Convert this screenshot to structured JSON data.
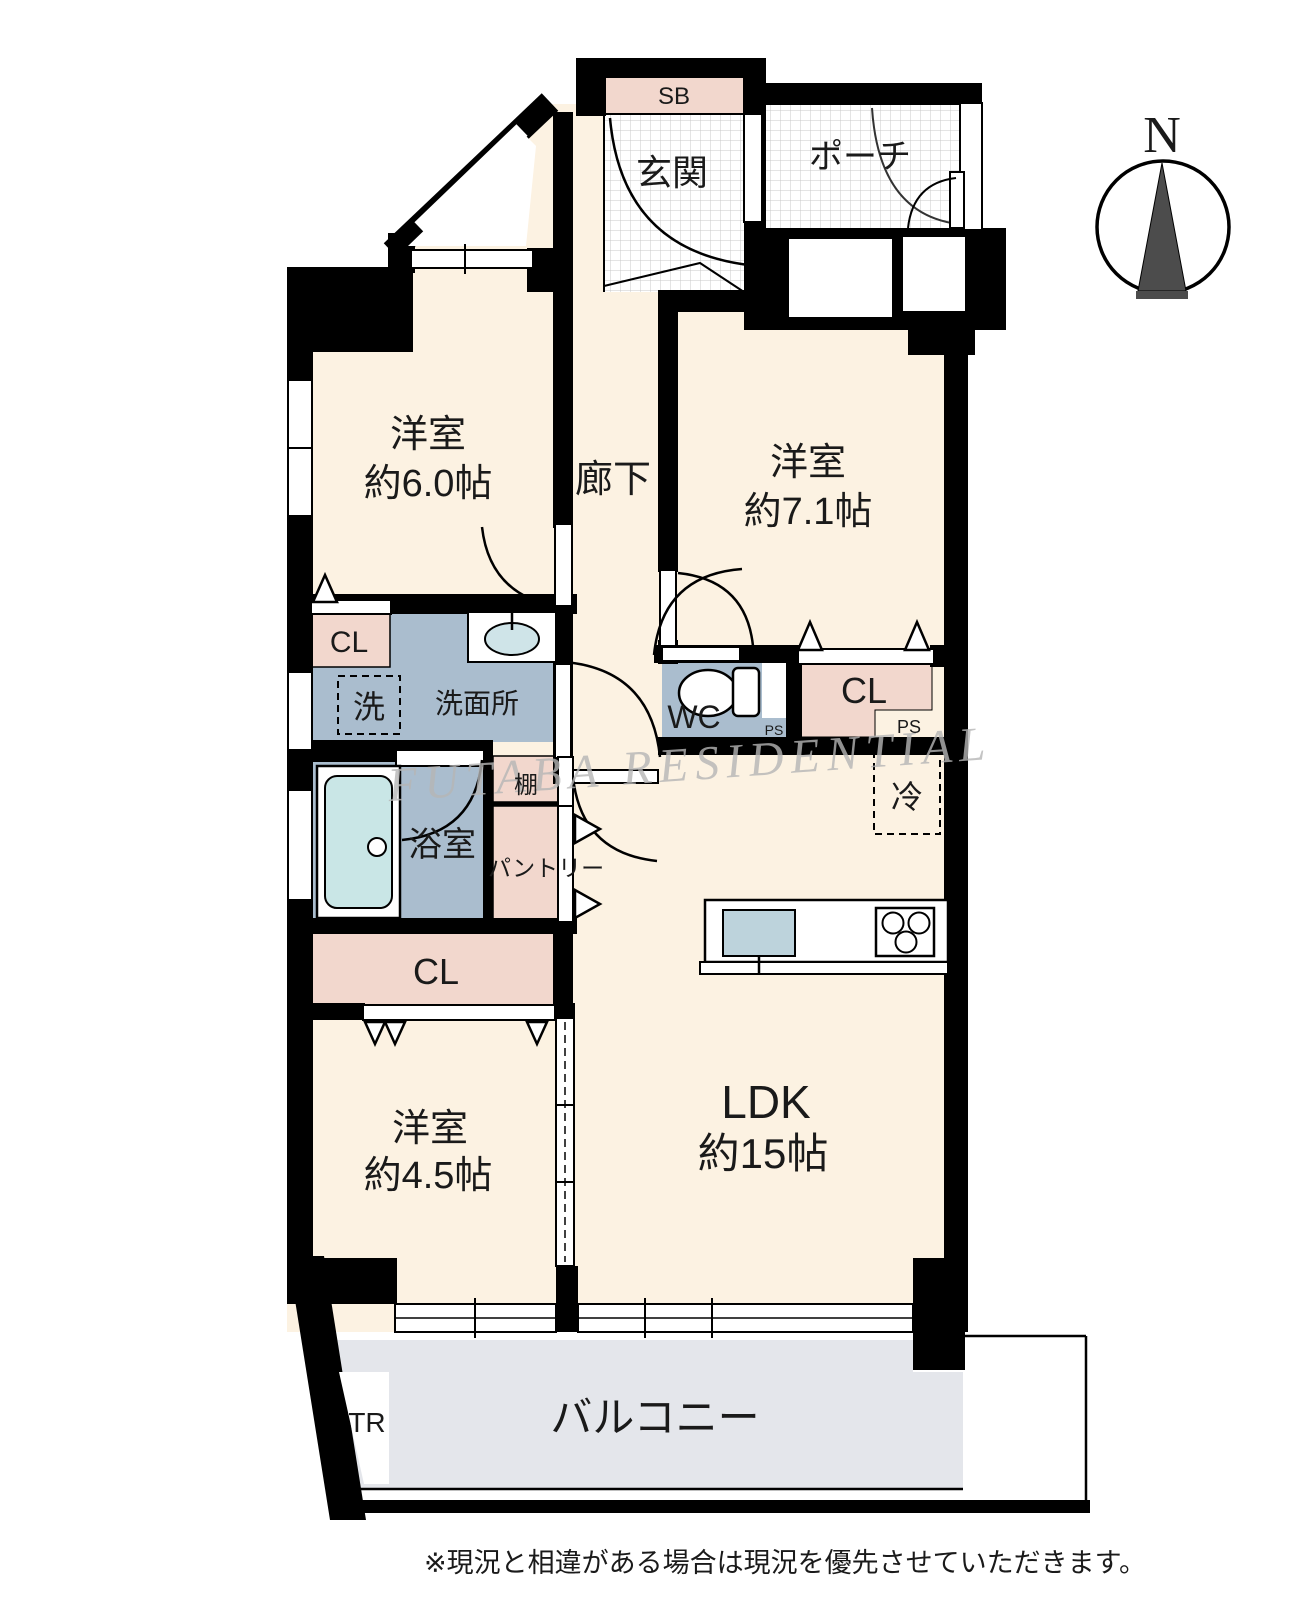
{
  "plan": {
    "labels": {
      "sb": "SB",
      "genkan": "玄関",
      "porch": "ポーチ",
      "room1_name": "洋室",
      "room1_size": "約6.0帖",
      "corridor": "廊下",
      "room2_name": "洋室",
      "room2_size": "約7.1帖",
      "cl": "CL",
      "washer": "洗",
      "washroom": "洗面所",
      "wc": "WC",
      "ps": "PS",
      "fridge": "冷",
      "bath": "浴室",
      "shelf": "棚",
      "pantry": "パントリー",
      "room3_name": "洋室",
      "room3_size": "約4.5帖",
      "ldk_name": "LDK",
      "ldk_size": "約15帖",
      "balcony": "バルコニー",
      "tr": "TR",
      "compass_north": "N",
      "watermark": "FUTABA RESIDENTIAL",
      "disclaimer": "※現況と相違がある場合は現況を優先させていただきます。"
    },
    "colors": {
      "room_cream": "#fcf2e2",
      "closet_pink": "#f2d7cd",
      "wet_blue": "#aabdce",
      "bathtub_cyan": "#c9e6e6",
      "sink_blue": "#bdd3dc",
      "balcony_gray": "#e4e6eb",
      "wall_black": "#000000",
      "grid_line": "#c9c9c9",
      "watermark_gray": "#b6b6b6",
      "compass_dark": "#4c4c4c"
    }
  }
}
